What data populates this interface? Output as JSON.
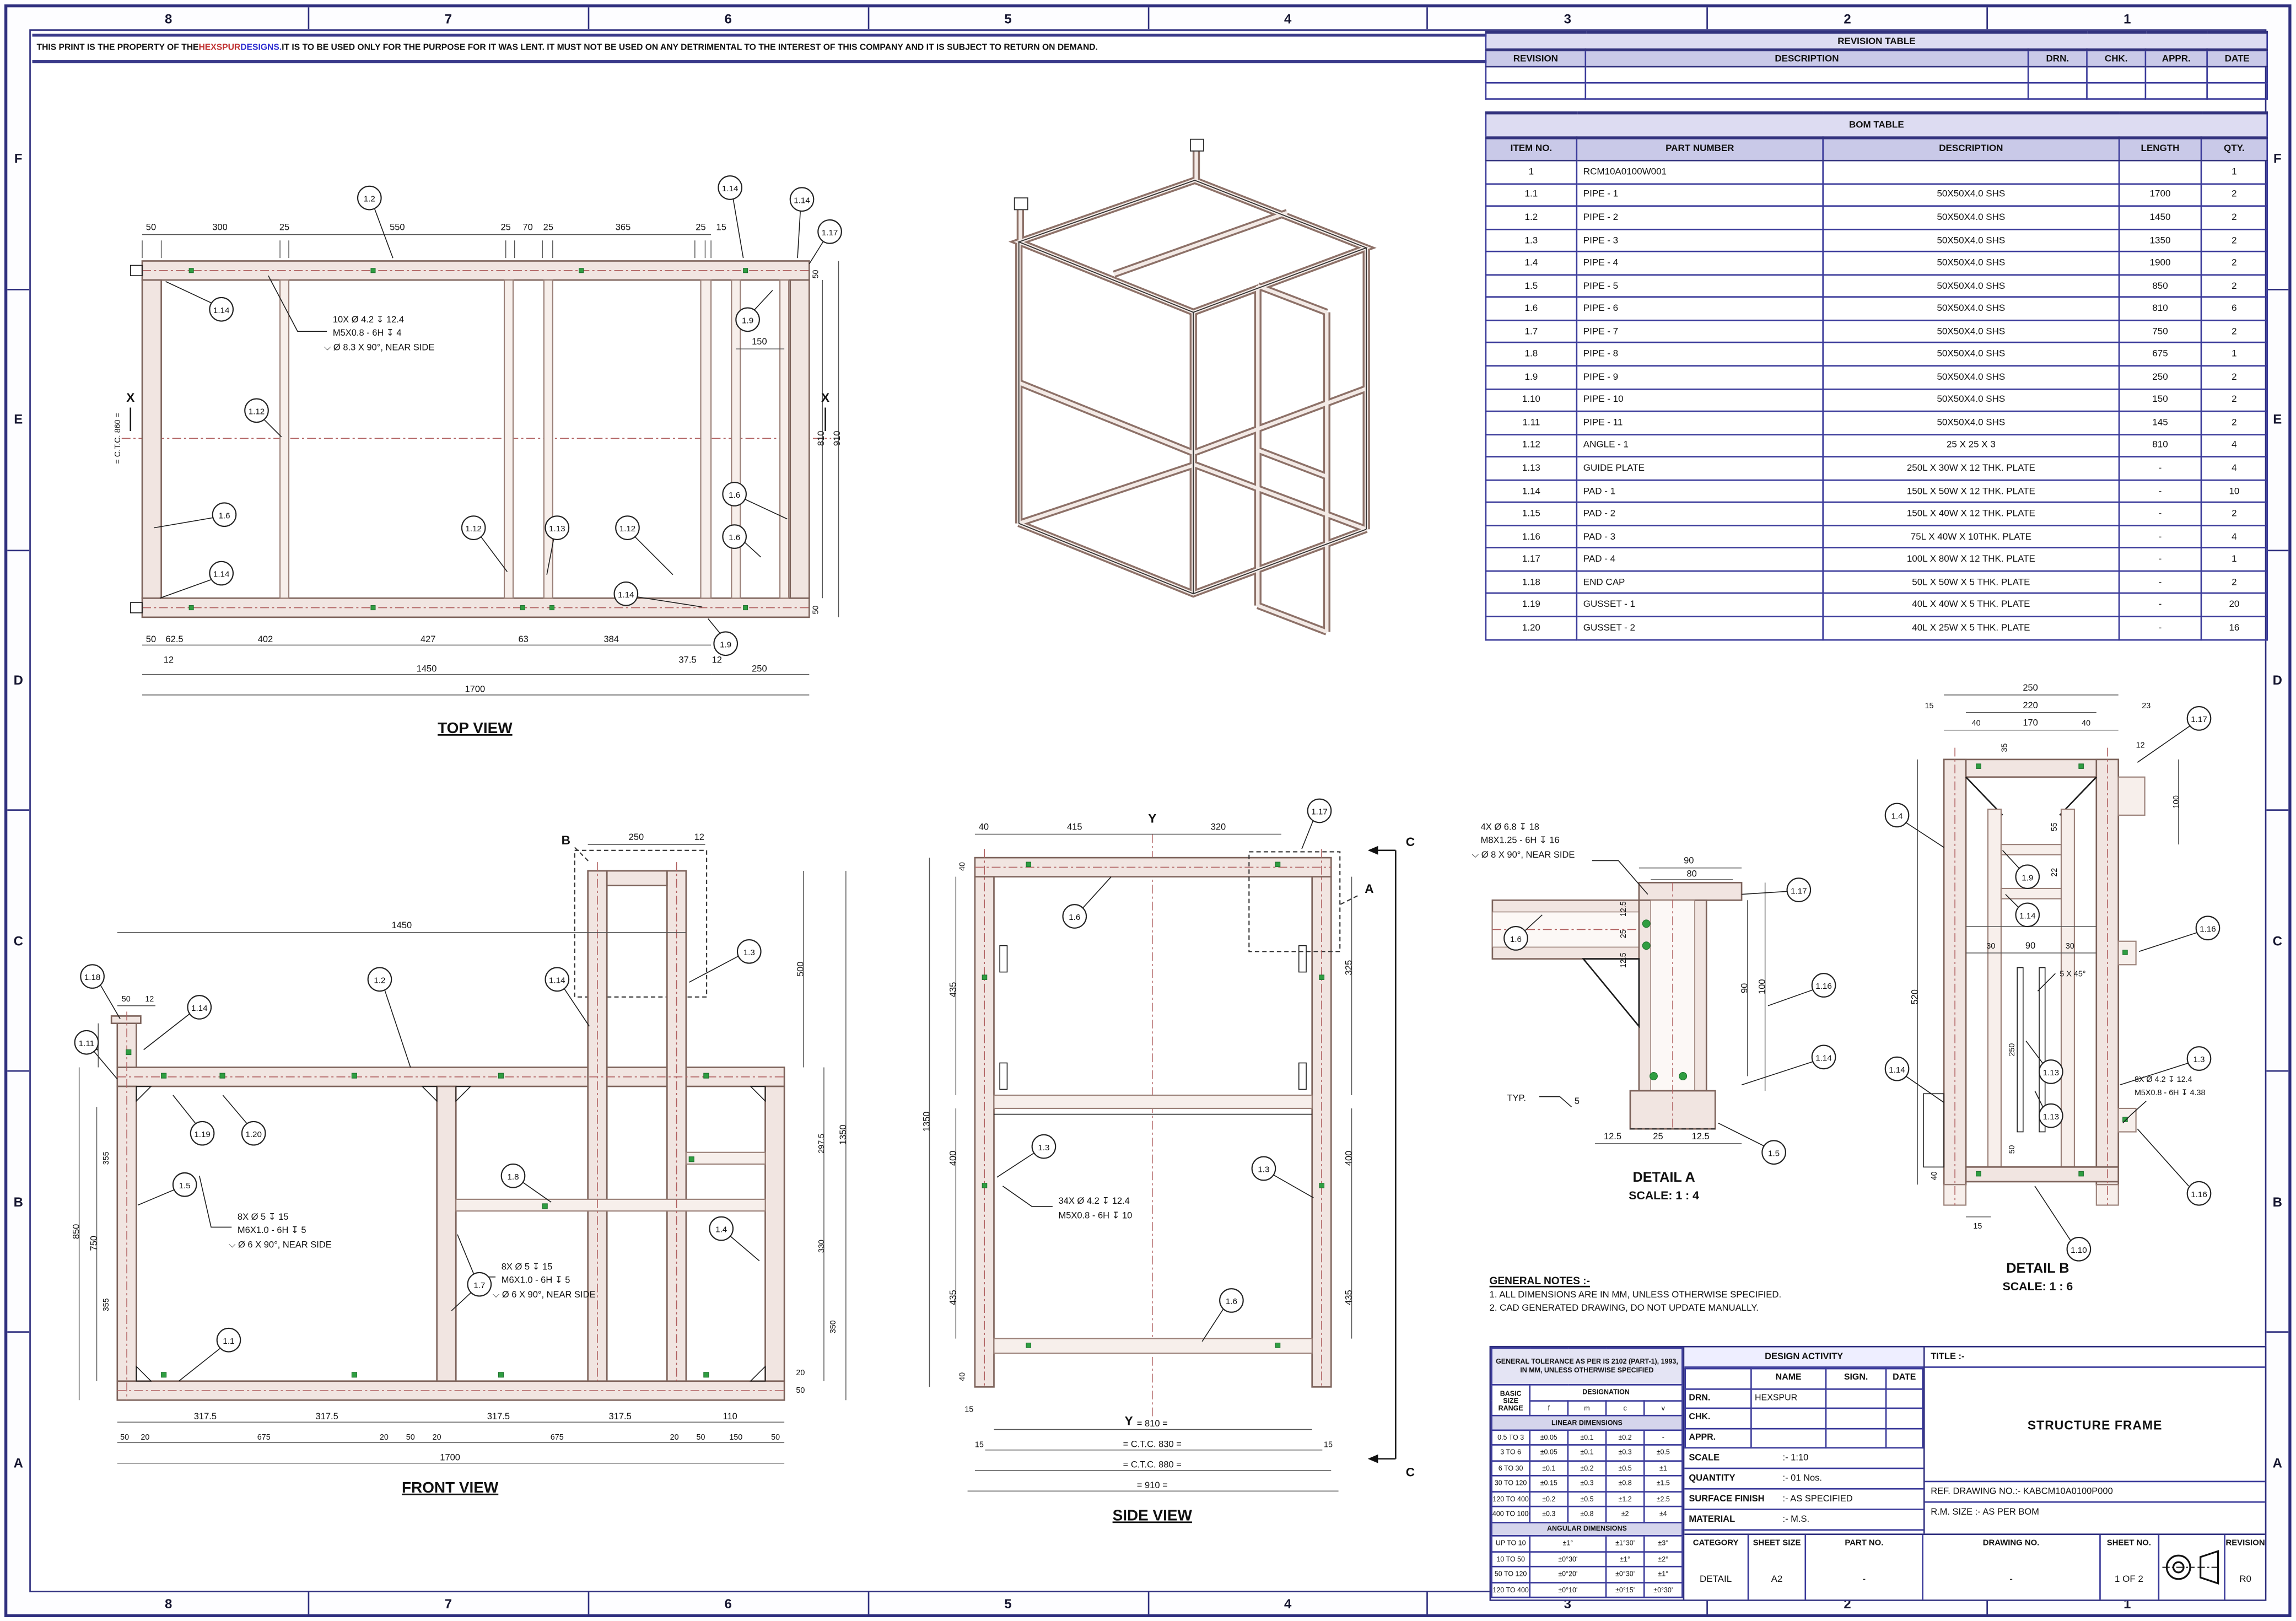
{
  "disclaimer": {
    "pre": "THIS PRINT IS THE PROPERTY OF THE ",
    "brand": "HEXSPUR",
    "brand2": " DESIGNS.",
    "post": " IT IS TO BE USED ONLY FOR THE PURPOSE FOR IT WAS LENT. IT MUST NOT BE USED ON ANY DETRIMENTAL TO THE INTEREST OF THIS COMPANY AND IT IS SUBJECT TO RETURN ON DEMAND."
  },
  "zones": {
    "top": [
      "8",
      "7",
      "6",
      "5",
      "4",
      "3",
      "2",
      "1"
    ],
    "bottom": [
      "8",
      "7",
      "6",
      "5",
      "4",
      "3",
      "2",
      "1"
    ],
    "left": [
      "F",
      "E",
      "D",
      "C",
      "B",
      "A"
    ],
    "right": [
      "F",
      "E",
      "D",
      "C",
      "B",
      "A"
    ]
  },
  "revision_table": {
    "title": "REVISION TABLE",
    "headers": [
      "REVISION",
      "DESCRIPTION",
      "DRN.",
      "CHK.",
      "APPR.",
      "DATE"
    ],
    "rows": [
      [
        "",
        "",
        "",
        "",
        "",
        ""
      ],
      [
        "",
        "",
        "",
        "",
        "",
        ""
      ]
    ]
  },
  "bom_table": {
    "title": "BOM TABLE",
    "headers": [
      "ITEM NO.",
      "PART NUMBER",
      "DESCRIPTION",
      "LENGTH",
      "QTY."
    ],
    "rows": [
      [
        "1",
        "RCM10A0100W001",
        "",
        "",
        "1"
      ],
      [
        "1.1",
        "PIPE - 1",
        "50X50X4.0 SHS",
        "1700",
        "2"
      ],
      [
        "1.2",
        "PIPE - 2",
        "50X50X4.0 SHS",
        "1450",
        "2"
      ],
      [
        "1.3",
        "PIPE - 3",
        "50X50X4.0 SHS",
        "1350",
        "2"
      ],
      [
        "1.4",
        "PIPE - 4",
        "50X50X4.0 SHS",
        "1900",
        "2"
      ],
      [
        "1.5",
        "PIPE - 5",
        "50X50X4.0 SHS",
        "850",
        "2"
      ],
      [
        "1.6",
        "PIPE - 6",
        "50X50X4.0 SHS",
        "810",
        "6"
      ],
      [
        "1.7",
        "PIPE - 7",
        "50X50X4.0 SHS",
        "750",
        "2"
      ],
      [
        "1.8",
        "PIPE - 8",
        "50X50X4.0 SHS",
        "675",
        "1"
      ],
      [
        "1.9",
        "PIPE - 9",
        "50X50X4.0 SHS",
        "250",
        "2"
      ],
      [
        "1.10",
        "PIPE - 10",
        "50X50X4.0 SHS",
        "150",
        "2"
      ],
      [
        "1.11",
        "PIPE - 11",
        "50X50X4.0 SHS",
        "145",
        "2"
      ],
      [
        "1.12",
        "ANGLE - 1",
        "25 X 25 X 3",
        "810",
        "4"
      ],
      [
        "1.13",
        "GUIDE PLATE",
        "250L X 30W X 12 THK. PLATE",
        "-",
        "4"
      ],
      [
        "1.14",
        "PAD - 1",
        "150L X 50W X 12 THK. PLATE",
        "-",
        "10"
      ],
      [
        "1.15",
        "PAD - 2",
        "150L X 40W X 12 THK. PLATE",
        "-",
        "2"
      ],
      [
        "1.16",
        "PAD - 3",
        "75L X 40W X 10THK. PLATE",
        "-",
        "4"
      ],
      [
        "1.17",
        "PAD - 4",
        "100L X 80W X 12 THK. PLATE",
        "-",
        "1"
      ],
      [
        "1.18",
        "END CAP",
        "50L X 50W X 5 THK. PLATE",
        "-",
        "2"
      ],
      [
        "1.19",
        "GUSSET - 1",
        "40L X 40W X 5 THK. PLATE",
        "-",
        "20"
      ],
      [
        "1.20",
        "GUSSET - 2",
        "40L X 25W X 5 THK. PLATE",
        "-",
        "16"
      ]
    ]
  },
  "general_notes": {
    "title": "GENERAL NOTES :-",
    "items": [
      "1.   ALL DIMENSIONS ARE IN MM, UNLESS OTHERWISE SPECIFIED.",
      "2.   CAD GENERATED DRAWING, DO NOT UPDATE MANUALLY."
    ]
  },
  "tolerance_table": {
    "title": "GENERAL TOLERANCE AS PER IS 2102 (PART-1), 1993, IN MM, UNLESS OTHERWISE SPECIFIED",
    "basic": "BASIC SIZE RANGE",
    "designation": "DESIGNATION",
    "cols": [
      "f",
      "m",
      "c",
      "v"
    ],
    "linear_label": "LINEAR DIMENSIONS",
    "linear_rows": [
      [
        "0.5 TO 3",
        "±0.05",
        "±0.1",
        "±0.2",
        "-"
      ],
      [
        "3 TO 6",
        "±0.05",
        "±0.1",
        "±0.3",
        "±0.5"
      ],
      [
        "6 TO 30",
        "±0.1",
        "±0.2",
        "±0.5",
        "±1"
      ],
      [
        "30 TO 120",
        "±0.15",
        "±0.3",
        "±0.8",
        "±1.5"
      ],
      [
        "120 TO 400",
        "±0.2",
        "±0.5",
        "±1.2",
        "±2.5"
      ],
      [
        "400 TO 1000",
        "±0.3",
        "±0.8",
        "±2",
        "±4"
      ]
    ],
    "angular_label": "ANGULAR DIMENSIONS",
    "angular_rows": [
      [
        "UP TO 10",
        "±1°",
        "±1°30'",
        "±3°"
      ],
      [
        "10 TO 50",
        "±0°30'",
        "±1°",
        "±2°"
      ],
      [
        "50 TO 120",
        "±0°20'",
        "±0°30'",
        "±1°"
      ],
      [
        "120 TO 400",
        "±0°10'",
        "±0°15'",
        "±0°30'"
      ]
    ]
  },
  "design_activity": {
    "title": "DESIGN ACTIVITY",
    "name_h": "NAME",
    "sign_h": "SIGN.",
    "date_h": "DATE",
    "drn_l": "DRN.",
    "drn_name": "HEXSPUR",
    "chk_l": "CHK.",
    "appr_l": "APPR.",
    "scale_l": "SCALE",
    "scale_v": ":-  1:10",
    "qty_l": "QUANTITY",
    "qty_v": ":-  01 Nos.",
    "sf_l": "SURFACE FINISH",
    "sf_v": ":-  AS SPECIFIED",
    "mat_l": "MATERIAL",
    "mat_v": ":-  M.S.",
    "wt_l": "WEIGHT",
    "wt_v": ":-  ~ 128.75 Kg"
  },
  "title_block": {
    "title_label": "TITLE :-",
    "title": "STRUCTURE FRAME",
    "ref": "REF. DRAWING NO.:-  KABCM10A0100P000",
    "rm": "R.M. SIZE          :-  AS PER BOM",
    "category_l": "CATEGORY",
    "category": "DETAIL",
    "sheet_size_l": "SHEET SIZE",
    "sheet_size": "A2",
    "part_no_l": "PART NO.",
    "part_no": "-",
    "drawing_no_l": "DRAWING NO.",
    "drawing_no": "-",
    "sheet_no_l": "SHEET NO.",
    "sheet_no": "1 OF 2",
    "revision_l": "REVISION",
    "revision": "R0"
  },
  "views": {
    "top": {
      "title": "TOP VIEW",
      "note": [
        "10X Ø 4.2 ↧ 12.4",
        "M5X0.8 - 6H ↧ 4",
        "⌵  Ø 8.3 X 90°, NEAR SIDE"
      ],
      "dims_top": [
        "50",
        "300",
        "25",
        "550",
        "25",
        "70",
        "25",
        "365",
        "25",
        "15"
      ],
      "dims_right": [
        "50",
        "810",
        "910",
        "50",
        "150"
      ],
      "dims_bottom": [
        "50",
        "62.5",
        "402",
        "427",
        "63",
        "384",
        "37.5",
        "12",
        "12"
      ],
      "dims_bottom2": [
        "1450",
        "250"
      ],
      "dim_total": "1700",
      "ctc": "= C.T.C. 860 =",
      "section_x": "X",
      "balloons": [
        "1.2",
        "1.14",
        "1.14",
        "1.17",
        "1.14",
        "1.9",
        "1.12",
        "1.6",
        "1.14",
        "1.12",
        "1.13",
        "1.12",
        "1.14",
        "1.6",
        "1.6",
        "1.9"
      ]
    },
    "front": {
      "title": "FRONT VIEW",
      "note1": [
        "8X Ø 5 ↧ 15",
        "M6X1.0 - 6H ↧ 5",
        "⌵  Ø 6 X 90°, NEAR SIDE"
      ],
      "note2": [
        "8X Ø 5 ↧ 15",
        "M6X1.0 - 6H ↧ 5",
        "⌵  Ø 6 X 90°, NEAR SIDE"
      ],
      "dims_top": [
        "1450",
        "250",
        "12",
        "50",
        "12"
      ],
      "dims_left": [
        "150",
        "850",
        "750",
        "355",
        "355"
      ],
      "dims_right": [
        "500",
        "1350",
        "297.5",
        "330",
        "350",
        "20",
        "50"
      ],
      "dims_bottom": [
        "317.5",
        "317.5",
        "317.5",
        "317.5",
        "110"
      ],
      "dims_bottom2": [
        "50",
        "20",
        "675",
        "20",
        "50",
        "20",
        "675",
        "20",
        "50",
        "150",
        "50"
      ],
      "dim_total": "1700",
      "marker_b": "B",
      "balloons": [
        "1.18",
        "1.14",
        "1.11",
        "1.2",
        "1.14",
        "1.3",
        "1.19",
        "1.20",
        "1.5",
        "1.8",
        "1.4",
        "1.7",
        "1.1"
      ]
    },
    "side": {
      "title": "SIDE VIEW",
      "note": [
        "34X Ø 4.2 ↧ 12.4",
        "M5X0.8 - 6H ↧ 10"
      ],
      "dims_top": [
        "40",
        "415",
        "320"
      ],
      "dims_left": [
        "40",
        "435",
        "1350",
        "400",
        "435",
        "40",
        "15"
      ],
      "dims_right": [
        "325",
        "400",
        "435"
      ],
      "dims_bottom": [
        "= 810 =",
        "= C.T.C. 830 =",
        "= C.T.C. 880 =",
        "= 910 =",
        "15",
        "15"
      ],
      "marker_y": "Y",
      "marker_c": "C",
      "marker_a": "A",
      "balloons": [
        "1.17",
        "1.6",
        "1.3",
        "1.3",
        "1.6"
      ]
    },
    "detail_a": {
      "title": "DETAIL A",
      "scale": "SCALE: 1 : 4",
      "note": [
        "4X Ø 6.8 ↧ 18",
        "M8X1.25 - 6H ↧ 16",
        "⌵  Ø 8 X 90°, NEAR SIDE"
      ],
      "typ": "TYP.",
      "weld": "5",
      "dims": [
        "90",
        "80",
        "100",
        "90",
        "12.5",
        "25",
        "12.5",
        "12.5",
        "25",
        "12.5"
      ],
      "balloons": [
        "1.6",
        "1.17",
        "1.16",
        "1.14",
        "1.5"
      ]
    },
    "detail_b": {
      "title": "DETAIL B",
      "scale": "SCALE: 1 : 6",
      "note": [
        "8X Ø 4.2 ↧ 12.4",
        "M5X0.8 - 6H ↧ 4.38"
      ],
      "chamfer": "5 X 45°",
      "dims": [
        "250",
        "220",
        "15",
        "23",
        "40",
        "170",
        "40",
        "35",
        "12",
        "100",
        "55",
        "22",
        "150",
        "30",
        "90",
        "30",
        "520",
        "250",
        "50",
        "40",
        "15"
      ],
      "balloons": [
        "1.17",
        "1.4",
        "1.9",
        "1.14",
        "1.16",
        "1.3",
        "1.16",
        "1.14",
        "1.13",
        "1.13",
        "1.10"
      ]
    }
  }
}
